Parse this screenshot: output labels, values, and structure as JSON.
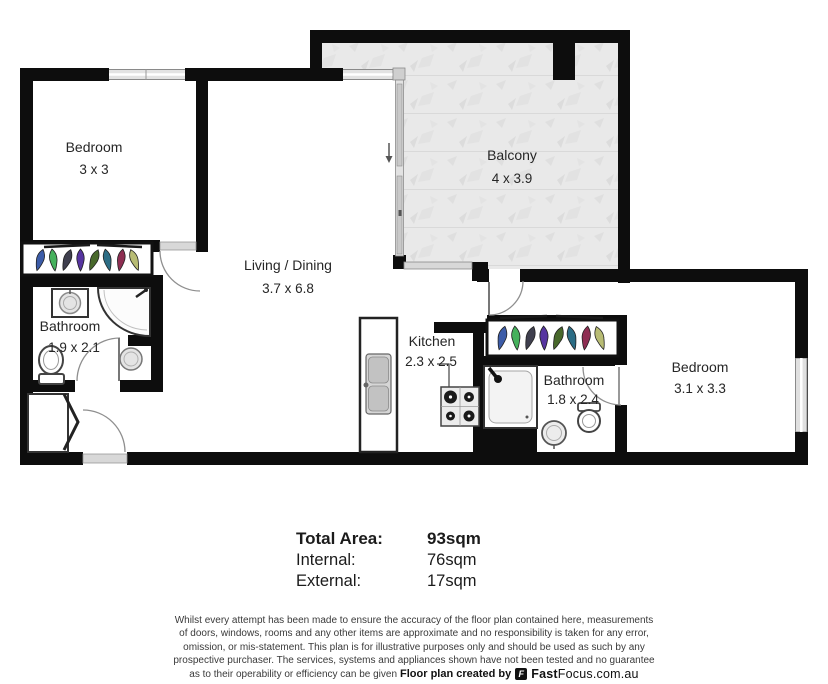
{
  "rooms": [
    {
      "id": "bedroom-1",
      "name": "Bedroom",
      "dims": "3 x 3"
    },
    {
      "id": "living-dining",
      "name": "Living / Dining",
      "dims": "3.7 x 6.8"
    },
    {
      "id": "balcony",
      "name": "Balcony",
      "dims": "4 x 3.9"
    },
    {
      "id": "bathroom-1",
      "name": "Bathroom",
      "dims": "1.9 x 2.1"
    },
    {
      "id": "kitchen",
      "name": "Kitchen",
      "dims": "2.3 x 2.5"
    },
    {
      "id": "bathroom-2",
      "name": "Bathroom",
      "dims": "1.8 x 2.4"
    },
    {
      "id": "bedroom-2",
      "name": "Bedroom",
      "dims": "3.1 x 3.3"
    }
  ],
  "areas": {
    "rows": [
      {
        "label": "Total Area:",
        "value": "93sqm"
      },
      {
        "label": "Internal:",
        "value": "76sqm"
      },
      {
        "label": "External:",
        "value": "17sqm"
      }
    ]
  },
  "disclaimer": {
    "lines": [
      "Whilst every attempt has been made to ensure the accuracy of the floor plan contained here, measurements",
      "of doors, windows, rooms and any other items are approximate and no responsibility is taken for any error,",
      "omission, or mis-statement. This plan is for illustrative purposes only and should be used as such by any",
      "prospective purchaser. The services, systems and appliances shown have not been tested and no guarantee",
      "as to their operability or efficiency can be given"
    ],
    "credit_prefix": "Floor plan created by",
    "logo_letter": "F",
    "brand_bold": "Fast",
    "brand_rest": "Focus.com.au"
  },
  "colors": {
    "wall": "#0d0d0d",
    "balcony_floor": "#e9e9e9",
    "hangers": [
      "#3c5ca8",
      "#45b15c",
      "#3f3f4e",
      "#5634a0",
      "#48682b",
      "#2c6d85",
      "#8e2e52",
      "#b8bc74"
    ]
  }
}
